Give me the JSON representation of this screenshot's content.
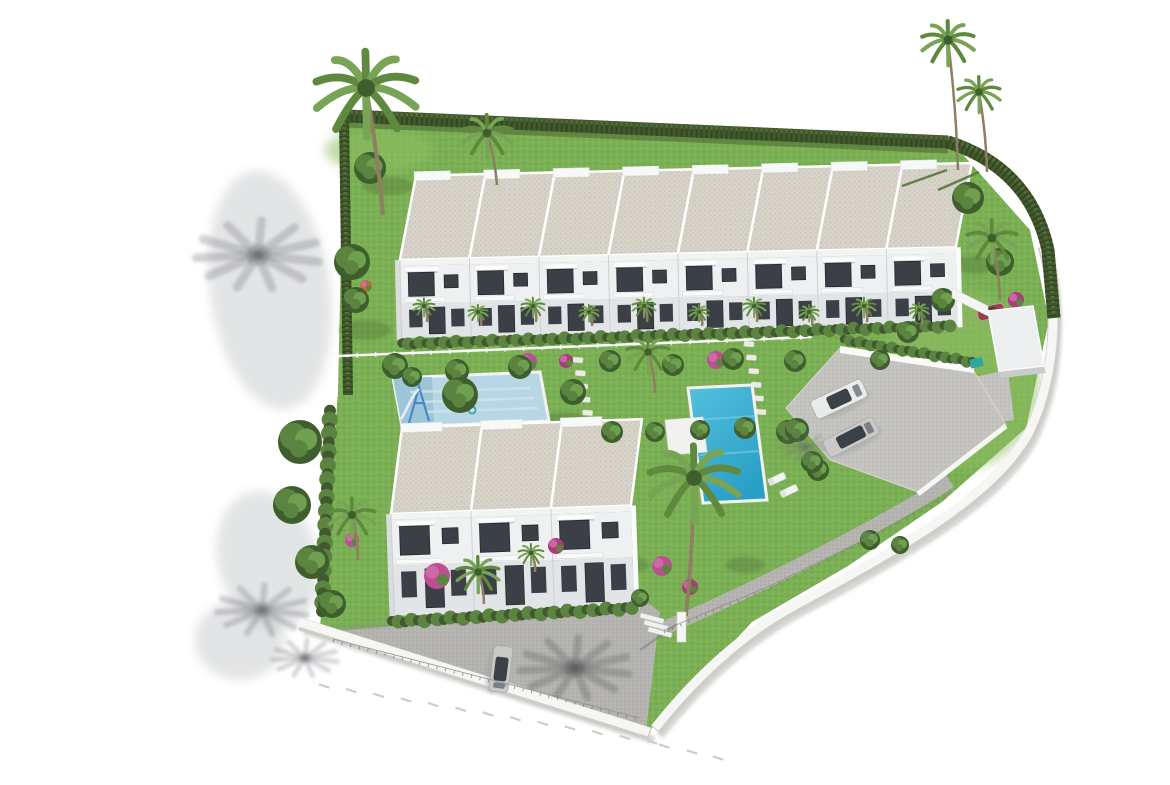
{
  "scene": {
    "kind": "aerial 3D architectural render of a coastal residential development",
    "elements": "two rows of white flat-roof townhouses, communal garden, kids pool, main turquoise pool, palm trees, parking with cars, white perimeter wall, internal asphalt road"
  },
  "colors": {
    "background": "#ffffff",
    "grass": "#7bb054",
    "grass_light": "#8fbe63",
    "grass_shade": "#587d3c",
    "hedge": "#42582e",
    "hedge_dark": "#33481f",
    "hedge_light": "#55703a",
    "tree_dark": "#3e5f2d",
    "tree_mid": "#5a8440",
    "tree_light": "#6fa050",
    "palm": "#5f8a3e",
    "palm_light": "#79a455",
    "trunk": "#8d7f60",
    "roof": "#d7d3c9",
    "roof_speck": "#c3beb3",
    "facade": "#eef0f1",
    "facade_shade": "#e2e5e7",
    "wall_white": "#f6f6f4",
    "wall_base": "#cfcdc9",
    "wall_shadow": "#c6c4c0",
    "window": "#3a4046",
    "window_dark": "#24282c",
    "asphalt": "#b6b4b0",
    "asphalt_speck": "#a7a5a1",
    "parking": "#c5c3bf",
    "pool_small": "#b7d7e4",
    "pool_small_deep": "#9cc6d8",
    "pool_main_1": "#54c0de",
    "pool_main_2": "#2a9fc6",
    "coping": "#f2f2ef",
    "deck": "#f1f2f0",
    "flower_pink": "#bb4f92",
    "flower_magenta": "#a83d7c",
    "flower_orange": "#c06a38",
    "car_white": "#e9eaea",
    "car_silver": "#c9cac8",
    "car_glass": "#3c4147",
    "car_red": "#a63a4a",
    "car_magenta": "#b8487e",
    "bin_teal": "#2fa6a0",
    "slide_blue": "#4a86c8",
    "shadow_gray": "#70747a",
    "shadow_soft": "#9aa0a4",
    "fence_white": "#fafafa",
    "white": "#fbfbfa"
  },
  "site": {
    "grass_polygon": "344,114 950,140 1030,230 1049,320 1026,428 942,502 848,566 752,622 656,726 648,730 320,628 338,392",
    "light_patches": [
      [
        380,
        150,
        55,
        22
      ],
      [
        960,
        380,
        80,
        90
      ],
      [
        900,
        230,
        60,
        50
      ]
    ],
    "shade_patches": [
      [
        365,
        330,
        26,
        10
      ],
      [
        470,
        402,
        24,
        9
      ],
      [
        565,
        420,
        22,
        8
      ],
      [
        705,
        425,
        20,
        8
      ],
      [
        860,
        305,
        22,
        9
      ],
      [
        975,
        265,
        20,
        9
      ],
      [
        625,
        565,
        24,
        9
      ],
      [
        745,
        565,
        20,
        8
      ],
      [
        388,
        186,
        26,
        9
      ]
    ]
  },
  "roads": {
    "main_polygon": "314,633 648,603 660,612 646,731",
    "walkway_path": "M660,630 C730,600 800,566 870,528 C905,509 932,493 950,481",
    "parking_polygon": "786,408 840,348 972,368 1006,425 918,492 830,460",
    "gate_pad_polygon": "950,382 1008,370 1014,420 956,428",
    "planter_polygon": "840,346 974,366 974,373 840,353",
    "retaining_line": [
      1006,
      426,
      918,
      494
    ],
    "building_shadow_line": [
      320,
      630,
      640,
      604
    ]
  },
  "walls": {
    "left_path": "M300,624 L650,734",
    "right_path": "M1044,246 C1060,300 1058,375 1030,434 C996,498 898,552 798,606 C742,636 694,682 656,730"
  },
  "hedges": {
    "top_path": "M346,116 L948,142",
    "right_path": "M948,142 Q1030,168 1048,250 L1054,318",
    "left_path": "M344,116 L348,395",
    "top_shadow_path": "M346,125 L948,151"
  },
  "fence_mid": [
    338,
    356,
    812,
    337
  ],
  "stone_paths": [
    [
      578,
      360,
      590,
      426,
      6
    ],
    [
      749,
      344,
      761,
      412,
      6
    ]
  ],
  "pools": {
    "kids_outline": "393,378 540,372 549,421 402,427",
    "kids_shallow": "393,378 432,377 434,426 402,427",
    "main_outline": "688,388 752,385 767,500 703,503",
    "deck": "665,420 703,417 707,452 669,455",
    "loungers": [
      [
        777,
        479,
        -25
      ],
      [
        789,
        491,
        -25
      ]
    ]
  },
  "buildings": {
    "top": {
      "x": 398,
      "y": 176,
      "rot": -1.3,
      "units": 8,
      "unit_w": 69.5,
      "roof_h": 84,
      "roof_skew": 18,
      "upper_y": 90,
      "upper_h": 38,
      "lower_h": 34
    },
    "bottom": {
      "x": 388,
      "y": 428,
      "rot": -2.0,
      "units": 3,
      "unit_w": 80,
      "roof_h": 86,
      "roof_skew": 14,
      "upper_y": 92,
      "upper_h": 46,
      "lower_h": 50
    }
  },
  "bush_rows": [
    [
      402,
      344,
      950,
      326,
      5.5
    ],
    [
      392,
      622,
      632,
      608,
      6
    ],
    [
      844,
      340,
      972,
      362,
      5
    ],
    [
      330,
      412,
      322,
      610,
      7
    ]
  ],
  "vegetation": {
    "palms": [
      [
        366,
        88,
        52,
        383,
        215
      ],
      [
        487,
        133,
        26,
        497,
        185
      ],
      [
        948,
        40,
        27,
        958,
        170
      ],
      [
        979,
        92,
        22,
        987,
        172
      ],
      [
        992,
        238,
        26,
        1000,
        300
      ],
      [
        648,
        352,
        22,
        655,
        393
      ],
      [
        694,
        478,
        46,
        686,
        616
      ],
      [
        478,
        572,
        22,
        484,
        604
      ],
      [
        531,
        553,
        13,
        535,
        572
      ],
      [
        352,
        515,
        24,
        358,
        560
      ],
      [
        424,
        306,
        11,
        427,
        322
      ],
      [
        478,
        312,
        10,
        481,
        326
      ],
      [
        533,
        306,
        12,
        536,
        322
      ],
      [
        589,
        312,
        10,
        592,
        326
      ],
      [
        644,
        306,
        12,
        647,
        322
      ],
      [
        699,
        312,
        10,
        702,
        326
      ],
      [
        754,
        306,
        12,
        757,
        322
      ],
      [
        809,
        312,
        10,
        812,
        326
      ],
      [
        864,
        306,
        12,
        867,
        322
      ],
      [
        919,
        310,
        10,
        922,
        324
      ]
    ],
    "trees": [
      [
        370,
        168,
        16
      ],
      [
        352,
        262,
        18
      ],
      [
        356,
        300,
        13
      ],
      [
        300,
        442,
        22
      ],
      [
        292,
        505,
        19
      ],
      [
        312,
        562,
        17
      ],
      [
        332,
        604,
        14
      ],
      [
        395,
        366,
        13
      ],
      [
        457,
        371,
        12
      ],
      [
        520,
        367,
        12
      ],
      [
        610,
        361,
        11
      ],
      [
        673,
        365,
        11
      ],
      [
        733,
        359,
        11
      ],
      [
        795,
        361,
        11
      ],
      [
        460,
        395,
        18
      ],
      [
        412,
        377,
        10
      ],
      [
        573,
        392,
        13
      ],
      [
        612,
        432,
        11
      ],
      [
        655,
        432,
        10
      ],
      [
        700,
        430,
        10
      ],
      [
        745,
        428,
        11
      ],
      [
        788,
        432,
        12
      ],
      [
        818,
        470,
        11
      ],
      [
        968,
        198,
        16
      ],
      [
        1000,
        262,
        14
      ],
      [
        943,
        300,
        12
      ],
      [
        908,
        332,
        11
      ],
      [
        880,
        360,
        10
      ],
      [
        797,
        430,
        12
      ],
      [
        812,
        462,
        11
      ],
      [
        870,
        540,
        10
      ],
      [
        900,
        545,
        9
      ],
      [
        640,
        598,
        9
      ]
    ],
    "flowers": [
      [
        528,
        362,
        9,
        "flower_pink"
      ],
      [
        566,
        361,
        7,
        "flower_magenta"
      ],
      [
        716,
        360,
        9,
        "flower_pink"
      ],
      [
        1016,
        300,
        8,
        "flower_magenta"
      ],
      [
        366,
        286,
        6,
        "flower_orange"
      ],
      [
        437,
        576,
        13,
        "flower_pink"
      ],
      [
        556,
        546,
        8,
        "flower_magenta"
      ],
      [
        662,
        566,
        10,
        "flower_pink"
      ],
      [
        690,
        587,
        8,
        "flower_magenta"
      ],
      [
        352,
        540,
        7,
        "flower_pink"
      ]
    ]
  },
  "shadows": {
    "blobs": [
      [
        270,
        290,
        60,
        120,
        -8
      ],
      [
        268,
        560,
        50,
        70,
        -15
      ],
      [
        240,
        640,
        45,
        40,
        0
      ]
    ],
    "bursts_outside": [
      [
        258,
        255,
        62
      ],
      [
        262,
        610,
        45
      ],
      [
        305,
        658,
        33
      ]
    ],
    "burst_road": [
      575,
      668,
      55
    ],
    "burst_parking": [
      805,
      447,
      26
    ],
    "trunk_lines": [
      [
        947,
        170,
        902,
        186
      ],
      [
        979,
        172,
        938,
        190
      ]
    ]
  },
  "cars": [
    {
      "cx": 839,
      "cy": 399,
      "len": 56,
      "wid": 20,
      "rot": -25,
      "body": "car_white",
      "style": "suv"
    },
    {
      "cx": 851,
      "cy": 437,
      "len": 56,
      "wid": 19,
      "rot": -27,
      "body": "car_silver",
      "style": "sedan"
    },
    {
      "cx": 501,
      "cy": 669,
      "len": 46,
      "wid": 19,
      "rot": 97,
      "body": "car_silver",
      "style": "sedan"
    },
    {
      "cx": 991,
      "cy": 312,
      "len": 27,
      "wid": 13,
      "rot": -12,
      "body": "car_red",
      "style": "suv"
    },
    {
      "cx": 1027,
      "cy": 313,
      "len": 16,
      "wid": 12,
      "rot": -12,
      "body": "car_magenta",
      "style": "suv"
    }
  ],
  "gate": {
    "canopy": "988,311 1033,306 1044,366 999,371",
    "canopy_side": "999,371 1044,366 1046,373 1001,378",
    "wall": "952,288 988,306 988,316 952,298",
    "steps": [
      [
        641,
        613
      ],
      [
        645,
        620
      ],
      [
        649,
        627
      ]
    ],
    "pillar": [
      677,
      612,
      9,
      30
    ],
    "bin": [
      969,
      360,
      13,
      9
    ]
  },
  "ticks": {
    "x1": 324,
    "y1": 686,
    "x2": 652,
    "y2": 742,
    "count": 13,
    "extra": [
      [
        664,
        746
      ],
      [
        692,
        752
      ],
      [
        718,
        758
      ]
    ]
  },
  "wire_fences": [
    "M333,645 L640,724",
    "M664,636 L770,592 L872,542 L952,498"
  ],
  "slide": {
    "frame": "M409,423 L419,387 L429,421 M414,403 L425,403",
    "chute": "M419,389 C411,396 407,410 401,419",
    "ring": [
      472,
      410,
      3.5
    ]
  },
  "counts": {
    "top_row_units": 8,
    "bottom_row_units": 3,
    "parking_cars": 2,
    "total_visible_cars": 5,
    "pools": 2
  }
}
